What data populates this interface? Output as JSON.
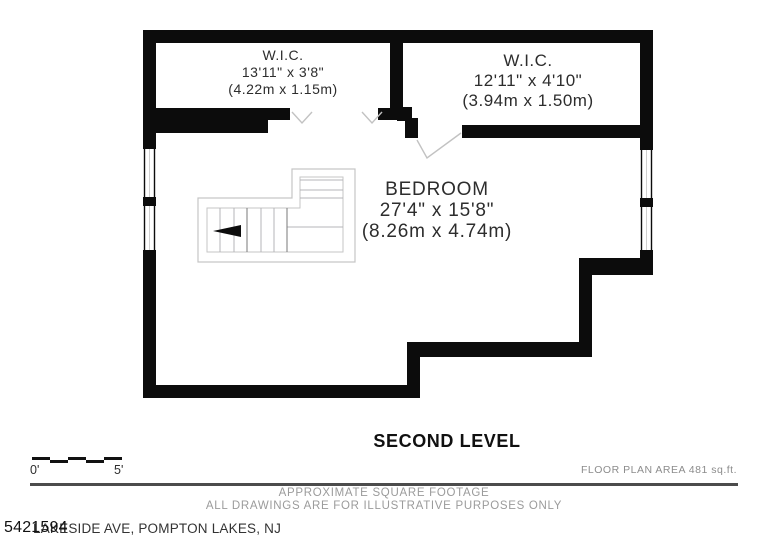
{
  "plan": {
    "rooms": {
      "wic_left": {
        "name": "W.I.C.",
        "imperial": "13'11\" x 3'8\"",
        "metric": "(4.22m x 1.15m)"
      },
      "wic_right": {
        "name": "W.I.C.",
        "imperial": "12'11\" x 4'10\"",
        "metric": "(3.94m x 1.50m)"
      },
      "bedroom": {
        "name": "BEDROOM",
        "imperial": "27'4\" x 15'8\"",
        "metric": "(8.26m x 4.74m)"
      }
    }
  },
  "title": "SECOND LEVEL",
  "scale_bar": {
    "start_label": "0'",
    "end_label": "5'"
  },
  "footer": {
    "area_note": "FLOOR PLAN AREA 481 sq.ft.",
    "disclaimer_line1": "APPROXIMATE SQUARE FOOTAGE",
    "disclaimer_line2": "ALL DRAWINGS ARE FOR ILLUSTRATIVE PURPOSES ONLY",
    "listing_number": "5421594",
    "address": "LAKESIDE AVE, POMPTON LAKES, NJ"
  },
  "colors": {
    "wall": "#0c0c0c",
    "plan_text": "#2d2d2d",
    "muted_text": "#9b9b9b",
    "divider": "#4c4c4c",
    "stair_line": "#c6c6c6"
  }
}
